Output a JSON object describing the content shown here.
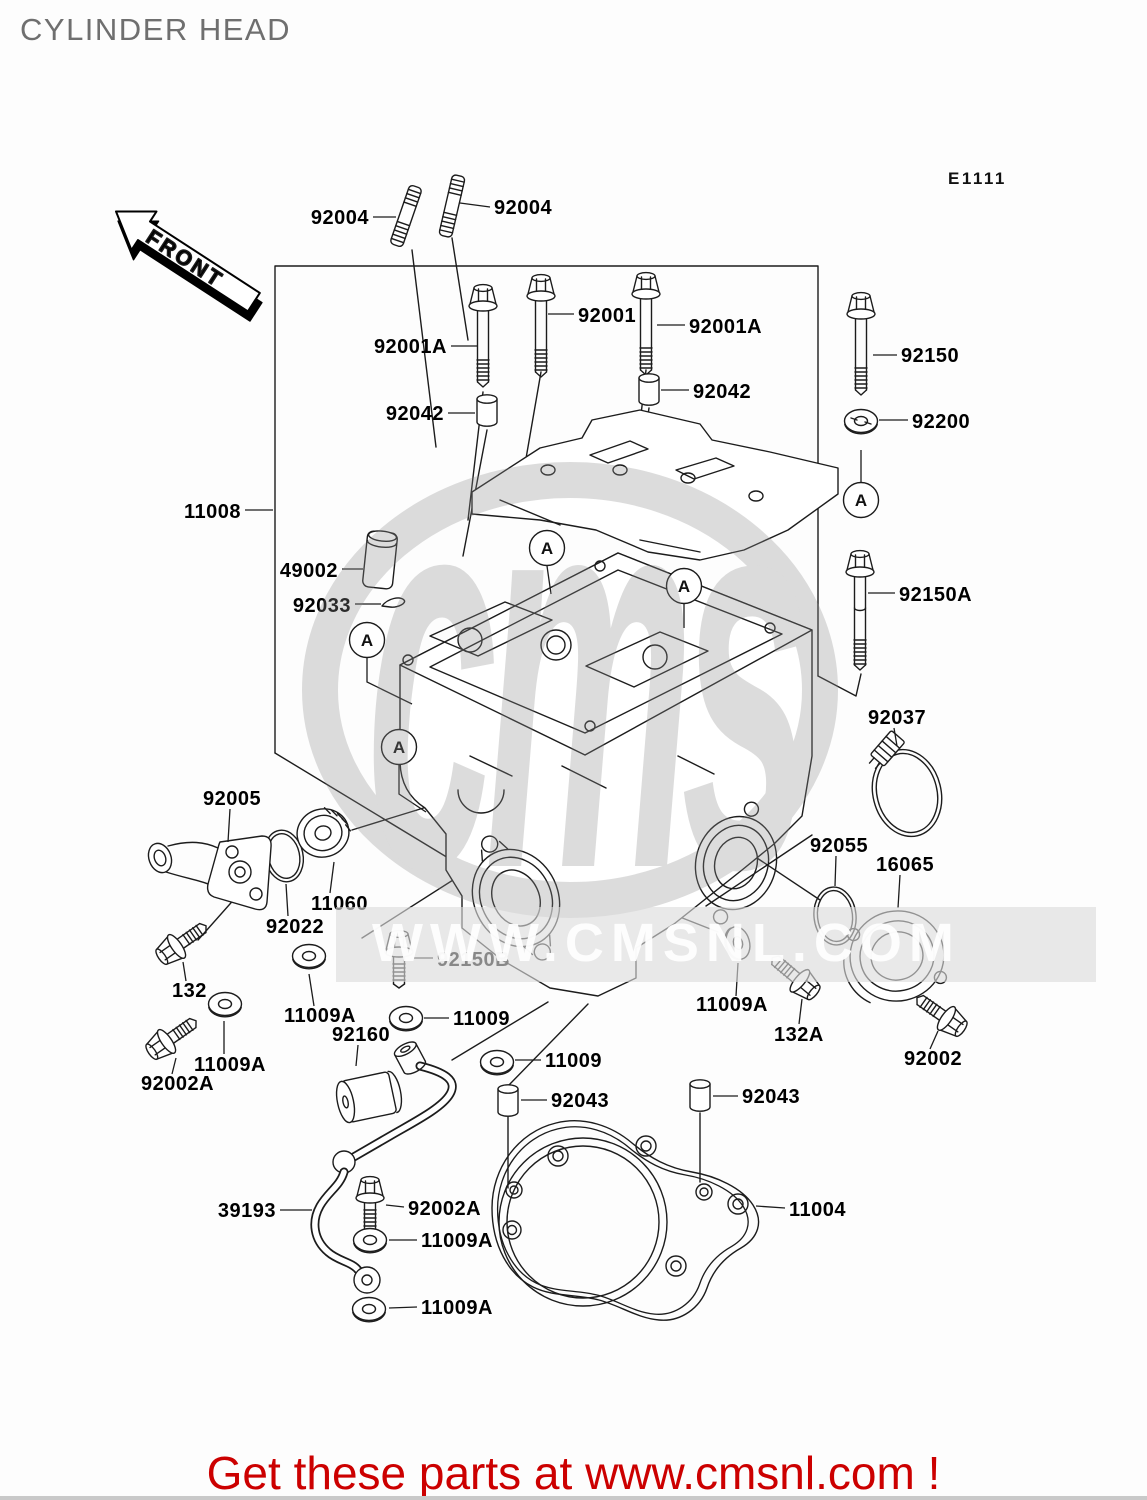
{
  "header": {
    "title": "CYLINDER HEAD"
  },
  "diagram": {
    "code": "E1111",
    "front_badge": "FRONT",
    "marker_letter": "A",
    "part_labels": [
      {
        "text": "92004"
      },
      {
        "text": "92004"
      },
      {
        "text": "92001A"
      },
      {
        "text": "92001"
      },
      {
        "text": "92001A"
      },
      {
        "text": "92150"
      },
      {
        "text": "92042"
      },
      {
        "text": "92042"
      },
      {
        "text": "92200"
      },
      {
        "text": "11008"
      },
      {
        "text": "49002"
      },
      {
        "text": "92033"
      },
      {
        "text": "92150A"
      },
      {
        "text": "92037"
      },
      {
        "text": "92005"
      },
      {
        "text": "11060"
      },
      {
        "text": "92022"
      },
      {
        "text": "92055"
      },
      {
        "text": "16065"
      },
      {
        "text": "132"
      },
      {
        "text": "92150B"
      },
      {
        "text": "11009A"
      },
      {
        "text": "92002A"
      },
      {
        "text": "11009A"
      },
      {
        "text": "92160"
      },
      {
        "text": "11009"
      },
      {
        "text": "11009"
      },
      {
        "text": "11009A"
      },
      {
        "text": "132A"
      },
      {
        "text": "92002"
      },
      {
        "text": "92043"
      },
      {
        "text": "92043"
      },
      {
        "text": "39193"
      },
      {
        "text": "92002A"
      },
      {
        "text": "11009A"
      },
      {
        "text": "11009A"
      },
      {
        "text": "11004"
      }
    ]
  },
  "watermark": {
    "logo": "cms",
    "url": "WWW.CMSNL.COM"
  },
  "footer": {
    "promo": "Get these parts at www.cmsnl.com !"
  }
}
